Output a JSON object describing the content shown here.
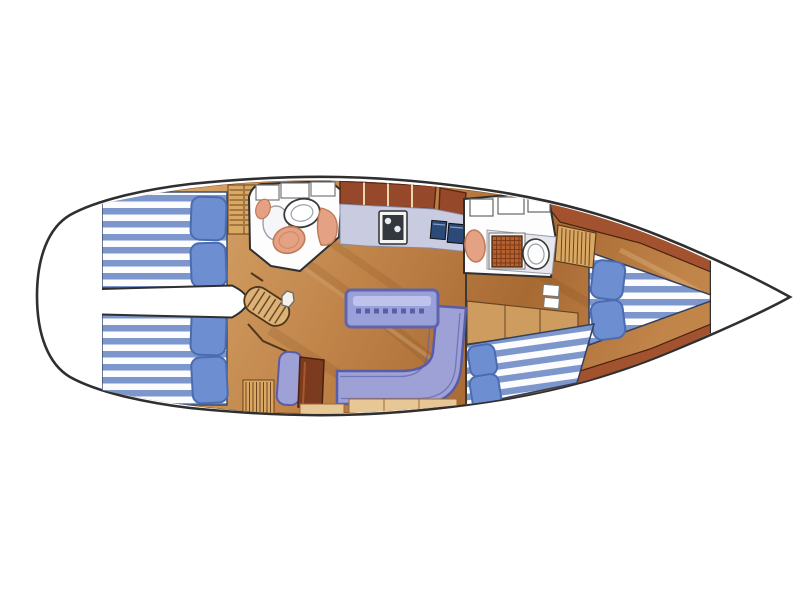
{
  "diagram": {
    "kind": "sailboat-interior-floor-plan",
    "orientation": "bow-right",
    "areas": {
      "stern_lazarette": "stern-lazarette",
      "aft_cabin_port": "aft-cabin-port-double-berth",
      "aft_cabin_starboard": "aft-cabin-starboard-double-berth",
      "companionway": "companionway-steps",
      "aft_head": "aft-head-bathroom",
      "galley": "galley",
      "salon": "salon",
      "forward_head": "forward-head-with-shower",
      "forward_cabin": "forward-cabin",
      "v_berth": "v-berth",
      "anchor_locker": "anchor-locker"
    },
    "colors": {
      "outline": "#2f2f2f",
      "hull_fill": "#ffffff",
      "wood_grad_light": "#dcae74",
      "wood_grad_mid": "#c1854a",
      "wood_grad_dark": "#a86a33",
      "wood_red_band": "#a2522f",
      "locker_red": "#96482a",
      "ladder_wood": "#dcb277",
      "wardrobe_wood": "#d9a863",
      "cabinet_face": "#cf9c60",
      "cabinet_dark": "#7c3a1e",
      "locker_front": "#e7c796",
      "mattress_blue": "#7d97cc",
      "mattress_white": "#fcfcfe",
      "pillow_blue": "#6e8ed2",
      "pillow_edge": "#4a6cb0",
      "upholstery": "#9da1d6",
      "upholstery_edge": "#595da8",
      "table_top": "#9aa0d8",
      "table_inlay": "#c6c9ee",
      "counter_lavender": "#c9cbe0",
      "head_counter": "#e8e6ee",
      "sink_blue": "#2c4a77",
      "salmon": "#e4a184",
      "salmon_edge": "#c07a58",
      "grate_red": "#b5602f",
      "room_white": "#fdfdfe",
      "stove_dark": "#33383f"
    }
  }
}
